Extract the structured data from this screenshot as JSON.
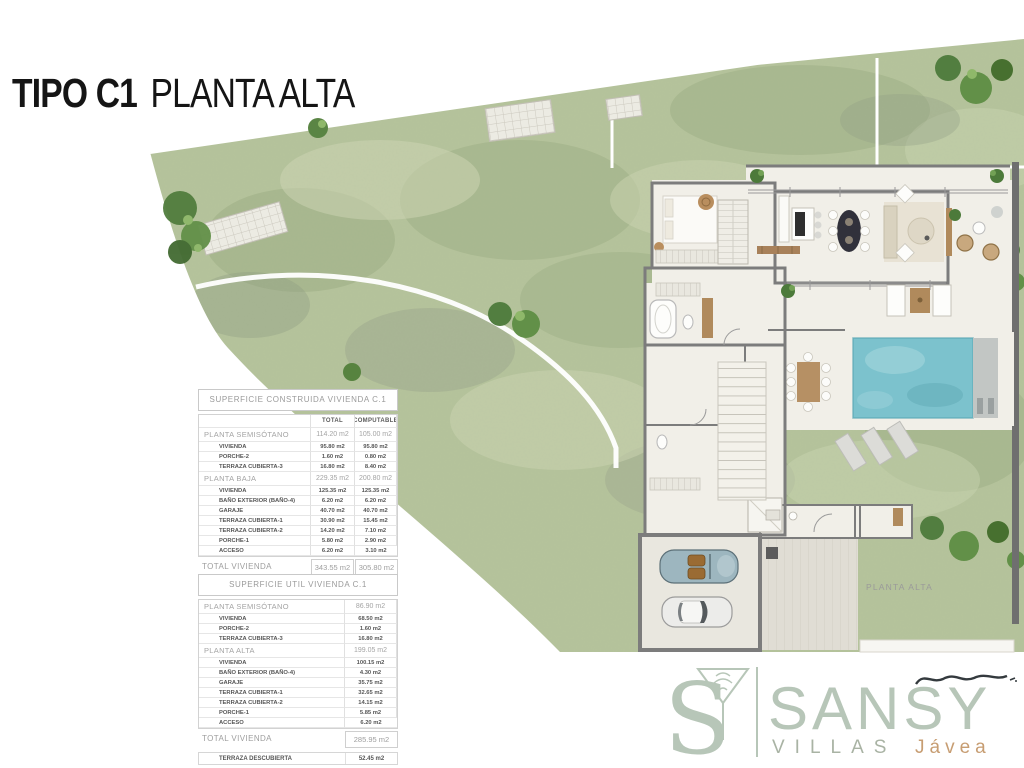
{
  "title": {
    "bold": "TIPO C1",
    "light": "PLANTA ALTA"
  },
  "plan": {
    "label": "PLANTA ALTA"
  },
  "tables": [
    {
      "title": "SUPERFICIE CONSTRUIDA VIVIENDA C.1",
      "columns": [
        "TOTAL",
        "COMPUTABLE"
      ],
      "rows": [
        {
          "label": "PLANTA SEMISÓTANO",
          "level": "group",
          "values": [
            "114.20 m2",
            "105.00 m2"
          ]
        },
        {
          "label": "VIVIENDA",
          "level": "sub",
          "values": [
            "95.80 m2",
            "95.80 m2"
          ]
        },
        {
          "label": "PORCHE-2",
          "level": "sub",
          "values": [
            "1.60 m2",
            "0.80 m2"
          ]
        },
        {
          "label": "TERRAZA CUBIERTA-3",
          "level": "sub",
          "values": [
            "16.80 m2",
            "8.40 m2"
          ]
        },
        {
          "label": "PLANTA BAJA",
          "level": "group",
          "values": [
            "229.35 m2",
            "200.80 m2"
          ]
        },
        {
          "label": "VIVIENDA",
          "level": "sub",
          "values": [
            "125.35 m2",
            "125.35 m2"
          ]
        },
        {
          "label": "BAÑO EXTERIOR (BAÑO-4)",
          "level": "sub",
          "values": [
            "6.20 m2",
            "6.20 m2"
          ]
        },
        {
          "label": "GARAJE",
          "level": "sub",
          "values": [
            "40.70 m2",
            "40.70 m2"
          ]
        },
        {
          "label": "TERRAZA CUBIERTA-1",
          "level": "sub",
          "values": [
            "30.90 m2",
            "15.45 m2"
          ]
        },
        {
          "label": "TERRAZA CUBIERTA-2",
          "level": "sub",
          "values": [
            "14.20 m2",
            "7.10 m2"
          ]
        },
        {
          "label": "PORCHE-1",
          "level": "sub",
          "values": [
            "5.80 m2",
            "2.90 m2"
          ]
        },
        {
          "label": "ACCESO",
          "level": "sub",
          "values": [
            "6.20 m2",
            "3.10 m2"
          ]
        }
      ],
      "total": {
        "label": "TOTAL VIVIENDA",
        "values": [
          "343.55 m2",
          "305.80 m2"
        ]
      },
      "extra": {
        "label": "TERRAZA DESCUBIERTA",
        "values": [
          "52.45 m2"
        ]
      }
    },
    {
      "title": "SUPERFICIE UTIL VIVIENDA C.1",
      "columns": [],
      "rows": [
        {
          "label": "PLANTA SEMISÓTANO",
          "level": "group",
          "values": [
            "86.90 m2"
          ]
        },
        {
          "label": "VIVIENDA",
          "level": "sub",
          "values": [
            "68.50 m2"
          ]
        },
        {
          "label": "PORCHE-2",
          "level": "sub",
          "values": [
            "1.60 m2"
          ]
        },
        {
          "label": "TERRAZA CUBIERTA-3",
          "level": "sub",
          "values": [
            "16.80 m2"
          ]
        },
        {
          "label": "PLANTA ALTA",
          "level": "group",
          "values": [
            "199.05 m2"
          ]
        },
        {
          "label": "VIVIENDA",
          "level": "sub",
          "values": [
            "100.15 m2"
          ]
        },
        {
          "label": "BAÑO EXTERIOR (BAÑO-4)",
          "level": "sub",
          "values": [
            "4.30 m2"
          ]
        },
        {
          "label": "GARAJE",
          "level": "sub",
          "values": [
            "35.75 m2"
          ]
        },
        {
          "label": "TERRAZA CUBIERTA-1",
          "level": "sub",
          "values": [
            "32.65 m2"
          ]
        },
        {
          "label": "TERRAZA CUBIERTA-2",
          "level": "sub",
          "values": [
            "14.15 m2"
          ]
        },
        {
          "label": "PORCHE-1",
          "level": "sub",
          "values": [
            "5.85 m2"
          ]
        },
        {
          "label": "ACCESO",
          "level": "sub",
          "values": [
            "6.20 m2"
          ]
        }
      ],
      "total": {
        "label": "TOTAL VIVIENDA",
        "values": [
          "285.95 m2"
        ]
      },
      "extra": {
        "label": "TERRAZA DESCUBIERTA",
        "values": [
          "52.45 m2"
        ]
      }
    }
  ],
  "logo": {
    "monogram_letter": "S",
    "brand": "SANSY",
    "line2_left": "VILLAS",
    "line2_right": "Jávea"
  },
  "colors": {
    "accent_sage": "#b7c6b8",
    "accent_tan": "#c79d72",
    "garden_green": "#b5c39b",
    "pool_blue": "#7cc2cd",
    "wall_grey": "#7c7c7c",
    "ink": "#161616"
  }
}
